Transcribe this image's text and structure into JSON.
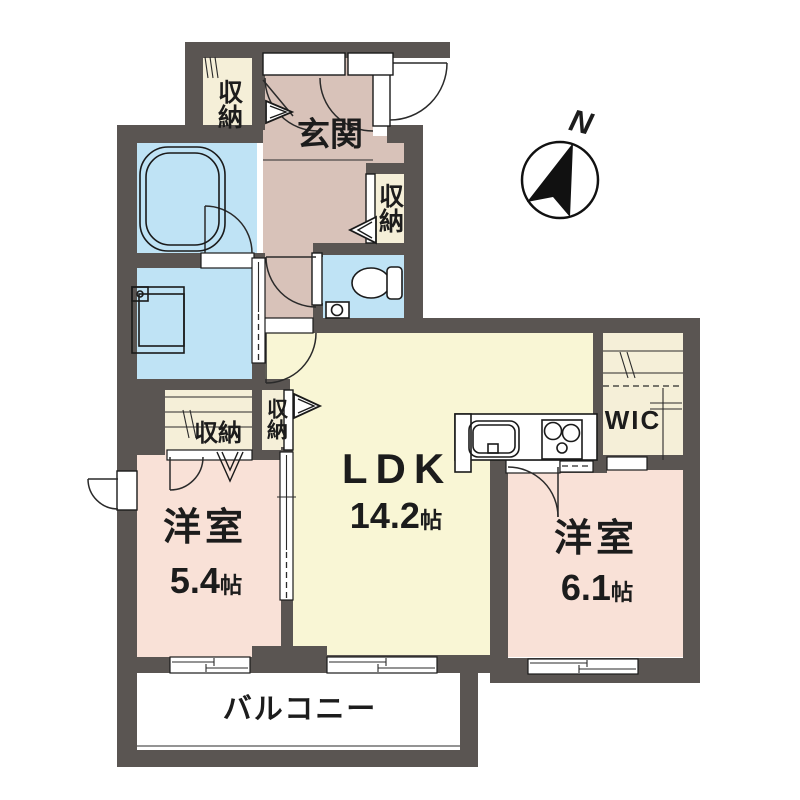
{
  "floorplan": {
    "compass": {
      "label": "N"
    },
    "rooms": {
      "genkan": {
        "label": "玄関"
      },
      "ldk": {
        "label": "LDK",
        "area_value": "14.2",
        "area_unit": "帖"
      },
      "bedroom_left": {
        "label": "洋室",
        "area_value": "5.4",
        "area_unit": "帖"
      },
      "bedroom_right": {
        "label": "洋室",
        "area_value": "6.1",
        "area_unit": "帖"
      },
      "wic": {
        "label": "WIC"
      },
      "balcony": {
        "label": "バルコニー"
      },
      "storage_entry": {
        "label": "収納"
      },
      "storage_hall": {
        "label": "収納"
      },
      "storage_bedroom": {
        "label": "収納"
      },
      "storage_ldk": {
        "label": "収納"
      }
    },
    "colors": {
      "wall": "#5a5552",
      "hall": "#d8c2b9",
      "water": "#bfe3f5",
      "ldk": "#f9f6d5",
      "closet": "#f5efd8",
      "bedroom": "#f9e1d7",
      "balcony": "#ffffff",
      "line": "#1a1a1a"
    }
  }
}
